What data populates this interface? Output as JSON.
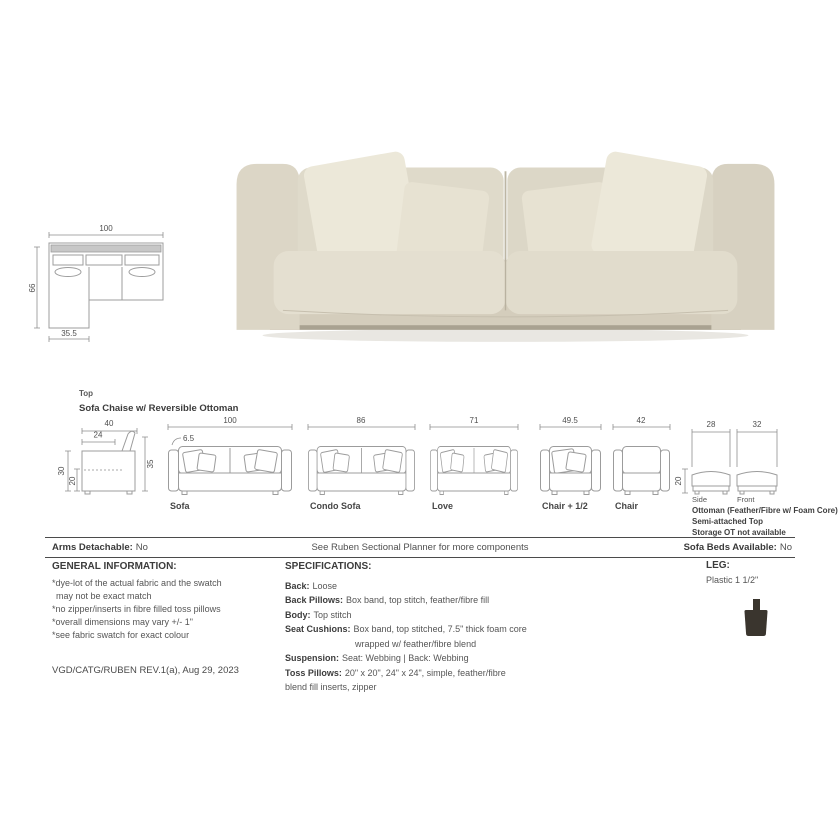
{
  "photo": {
    "description": "Cream fabric sofa with two seat cushions, two back cushions and four toss pillows",
    "colors": {
      "body": "#d8d2c2",
      "arm": "#dcd6c6",
      "back_cushion": "#dfdaca",
      "seat_cushion": "#e4dfd0",
      "pillow_outer": "#ece8d9",
      "pillow_inner": "#e7e2d2",
      "plinth_shadow": "#a9a291",
      "floor_shadow": "#e9e7e2"
    }
  },
  "plan": {
    "width": "100",
    "depth": "66",
    "chaise_width": "35.5"
  },
  "lineup": {
    "view_label": "Top",
    "title": "Sofa Chaise w/ Reversible Ottoman",
    "profile": {
      "total_depth": "40",
      "seat_depth": "24",
      "total_height": "30",
      "seat_height": "20",
      "back_height": "35"
    },
    "sofa": {
      "label": "Sofa",
      "width": "100",
      "arm_width": "6.5"
    },
    "condo": {
      "label": "Condo Sofa",
      "width": "86"
    },
    "love": {
      "label": "Love",
      "width": "71"
    },
    "chair_half": {
      "label": "Chair + 1/2",
      "width": "49.5"
    },
    "chair": {
      "label": "Chair",
      "width": "42"
    },
    "ottoman": {
      "side_width": "28",
      "front_width": "32",
      "height": "20",
      "side_label": "Side",
      "front_label": "Front",
      "caption1": "Ottoman (Feather/Fibre w/ Foam Core)",
      "caption2": "Semi-attached Top",
      "caption3": "Storage OT not available"
    }
  },
  "band": {
    "arms_label": "Arms Detachable:",
    "arms_value": "No",
    "note": "See Ruben Sectional Planner for more components",
    "beds_label": "Sofa Beds Available:",
    "beds_value": "No"
  },
  "general": {
    "heading": "GENERAL INFORMATION:",
    "lines": [
      "*dye-lot of the actual fabric and the swatch",
      "may not be exact match",
      "*no zipper/inserts in fibre filled toss pillows",
      "*overall dimensions may vary +/- 1\"",
      "*see fabric swatch for exact colour"
    ]
  },
  "specs": {
    "heading": "SPECIFICATIONS:",
    "rows": [
      {
        "label": "Back:",
        "value": "Loose"
      },
      {
        "label": "Back Pillows:",
        "value": "Box band, top stitch, feather/fibre fill"
      },
      {
        "label": "Body:",
        "value": "Top stitch"
      },
      {
        "label": "Seat Cushions:",
        "value": "Box band, top stitched, 7.5\" thick foam core",
        "value2": "wrapped w/ feather/fibre blend"
      },
      {
        "label": "Suspension:",
        "value": "Seat: Webbing  |  Back: Webbing"
      },
      {
        "label": "Toss Pillows:",
        "value": "20\" x 20\", 24\" x 24\", simple, feather/fibre",
        "value2": "blend fill inserts, zipper"
      }
    ]
  },
  "leg": {
    "heading": "LEG:",
    "value": "Plastic 1 1/2\"",
    "icon": "plastic-leg-icon",
    "icon_color": "#3a352e"
  },
  "footer": {
    "revision": "VGD/CATG/RUBEN REV.1(a), Aug 29, 2023"
  }
}
